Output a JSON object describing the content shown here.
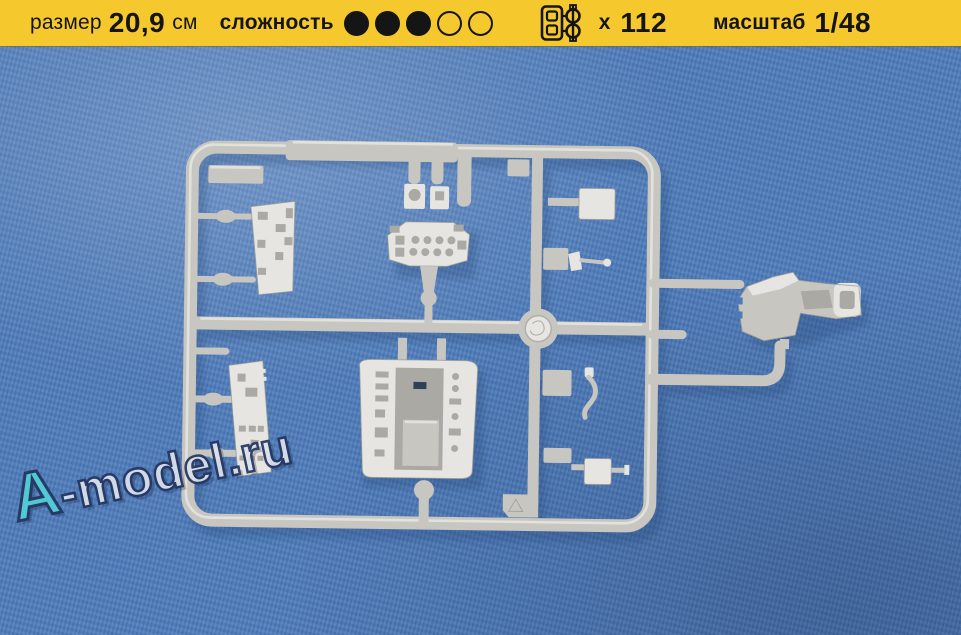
{
  "header": {
    "size": {
      "label": "размер",
      "value": "20,9",
      "unit": "см"
    },
    "difficulty": {
      "label": "сложность",
      "filled": 3,
      "total": 5
    },
    "parts": {
      "icon": "sprue-icon",
      "prefix": "x",
      "count": "112"
    },
    "scale": {
      "label": "масштаб",
      "value": "1/48"
    }
  },
  "photo": {
    "subject": "light grey injection-molded plastic sprue with aircraft cockpit parts (instrument panels, cockpit tub, ejection seat, control sticks) on blue fabric background",
    "watermark": {
      "prefix": "A",
      "suffix": "-model.ru"
    }
  },
  "colors": {
    "header_bg": "#f5c92e",
    "header_text": "#151515",
    "photo_bg": "#4d7bb9",
    "photo_bg_dark": "#3a63a1",
    "sprue_light": "#e6e5e1",
    "sprue_mid": "#c7c6c1",
    "sprue_dark": "#97968f",
    "sprue_recess": "#aaa9a4",
    "shadow_blue": "#27497a",
    "watermark_a": "#52d0d7",
    "watermark_text": "#dce2eb",
    "watermark_outline": "#243560"
  }
}
